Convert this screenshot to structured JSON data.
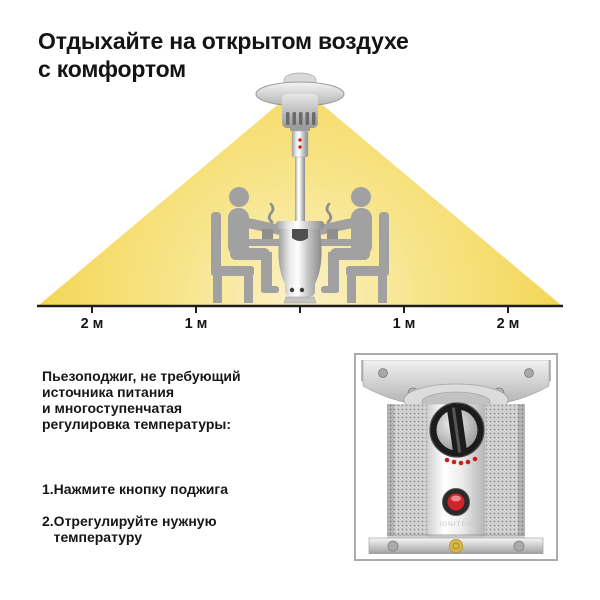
{
  "window": {
    "width": 600,
    "height": 600,
    "background": "#ffffff"
  },
  "header": {
    "title": "Отдыхайте на открытом воздухе\nс комфортом"
  },
  "diagram": {
    "axis_labels": [
      "2 м",
      "1 м",
      "1 м",
      "2 м"
    ],
    "icon_names": [
      "patio-heater-icon",
      "people-at-table-icon",
      "steam-icon",
      "heat-beam",
      "distance-axis"
    ]
  },
  "features": {
    "intro": "Пьезоподжиг, не требующий\nисточника питания\nи многоступенчатая\nрегулировка температуры:",
    "steps": [
      "1.Нажмите кнопку поджига",
      "2.Отрегулируйте нужную\n   температуру"
    ]
  },
  "photo": {
    "panel_label": "IGNITER"
  },
  "colors": {
    "beam_edge": "#F3D44E",
    "beam_mid": "#F7E488",
    "beam_center": "#FAF1C6",
    "silhouette": "#A1A1A1",
    "steam": "#8E8E8E",
    "axis": "#1d1d1d",
    "ignition_button_red": "#CE2328",
    "knob_dark": "#1c1c1c",
    "photo_border": "#ABABAB"
  }
}
